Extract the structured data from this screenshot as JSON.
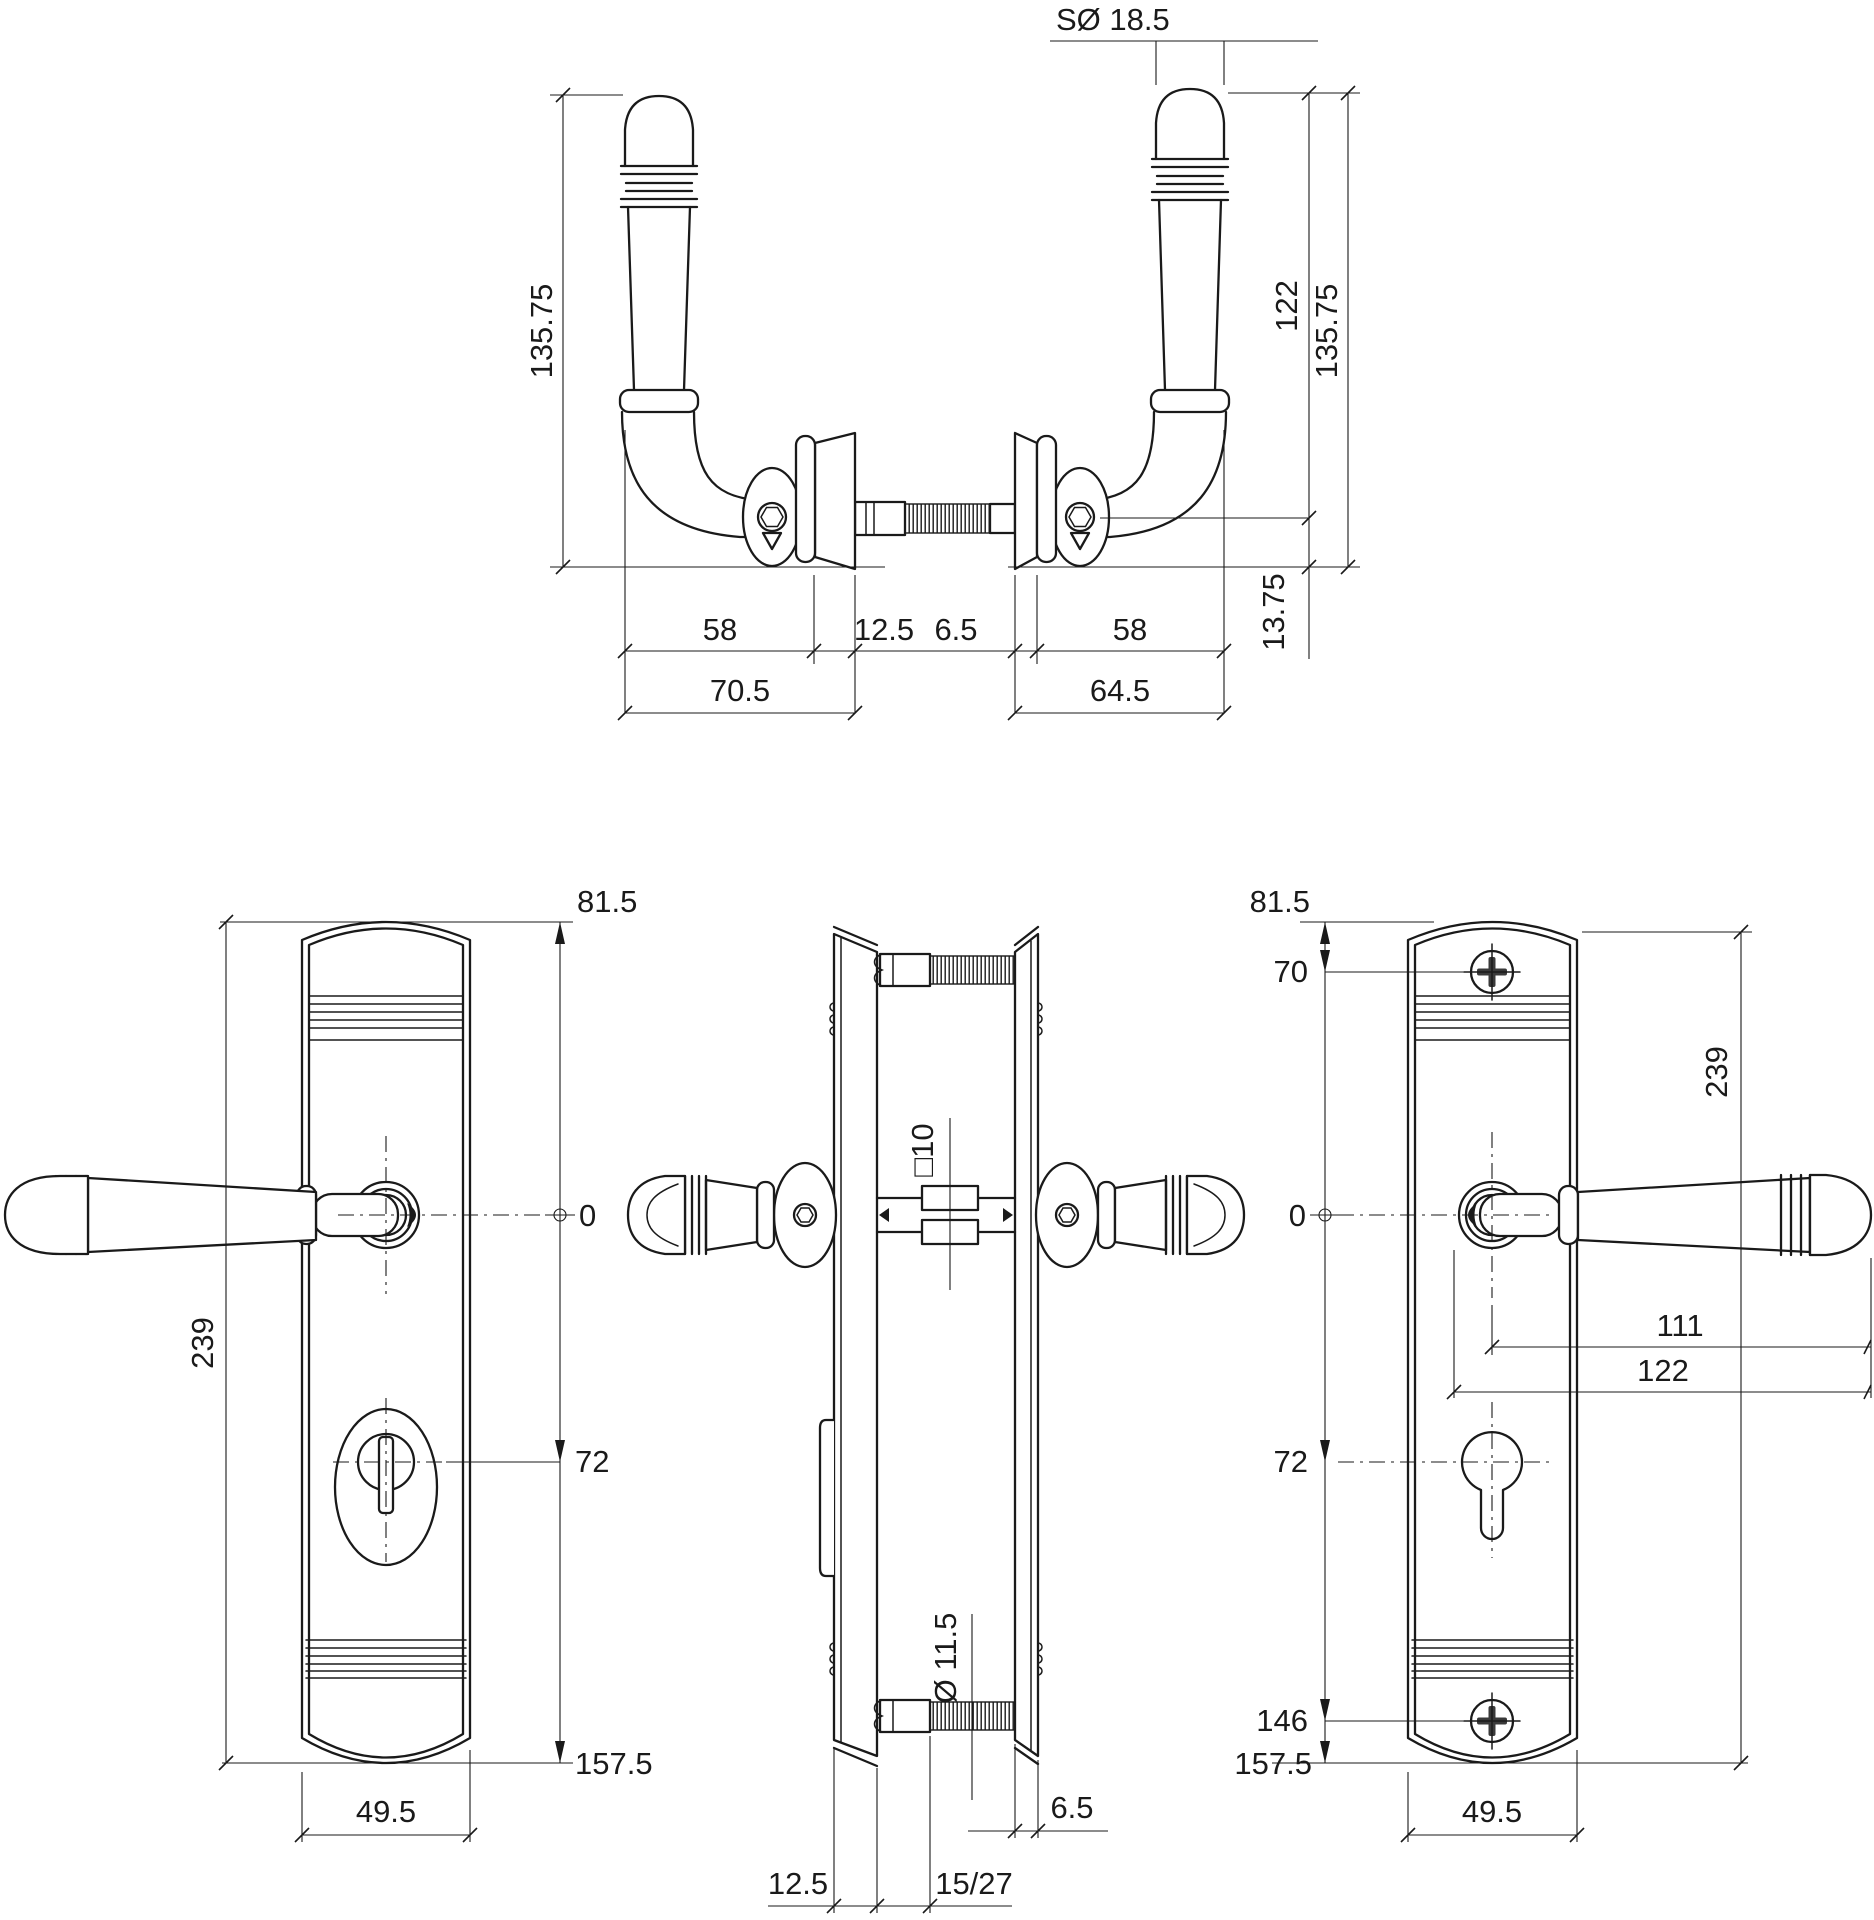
{
  "meta": {
    "background": "#ffffff",
    "line_color": "#1a1a1a",
    "drawing_type": "door-security-fitting-technical-drawing"
  },
  "dims": {
    "top": {
      "sphere_dia": "SØ 18.5",
      "h_left_total": "135.75",
      "h_right_axis": "122",
      "h_right_total": "135.75",
      "axis_base": "13.75",
      "grip_l": "58",
      "rose_t": "12.5",
      "washer_t": "6.5",
      "grip_r": "58",
      "proj_l": "70.5",
      "proj_r": "64.5"
    },
    "left": {
      "top_axis": "81.5",
      "zero": "0",
      "axis_cyl": "72",
      "axis_bottom": "157.5",
      "height": "239",
      "width": "49.5"
    },
    "side": {
      "spindle": "□10",
      "screw_dia": "Ø 11.5",
      "plate_r_t": "6.5",
      "plate_l_t": "12.5",
      "spindle_len": "15/27"
    },
    "right": {
      "top_axis": "81.5",
      "screw_top": "70",
      "height": "239",
      "zero": "0",
      "axis_tip": "111",
      "rose_tip": "122",
      "axis_cyl": "72",
      "axis_screw": "146",
      "axis_bottom": "157.5",
      "width": "49.5"
    }
  }
}
